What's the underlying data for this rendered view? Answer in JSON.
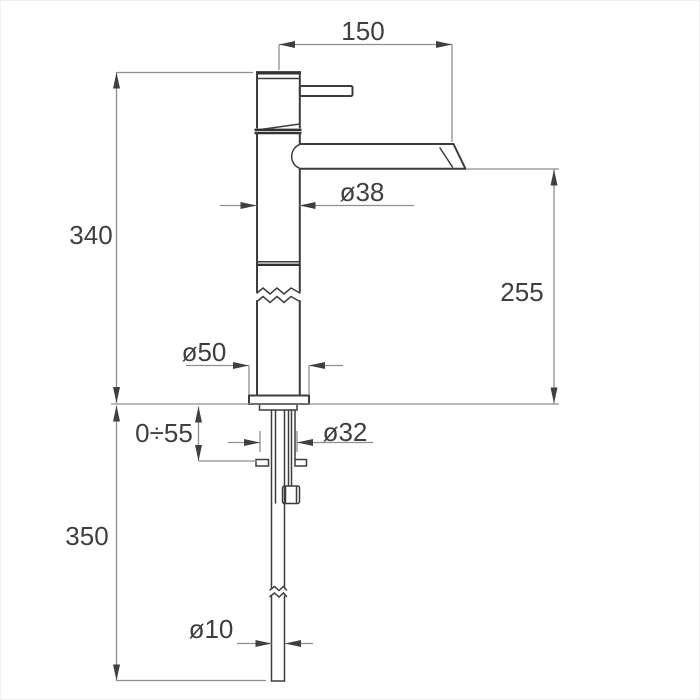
{
  "drawing": {
    "kind": "technical-dimension-drawing",
    "subject": "tall single-lever basin mixer tap, side elevation with installation dimensions",
    "units": "mm",
    "colors": {
      "outline": "#3d3d3d",
      "dimension_lines": "#8f8f8f",
      "text": "#3f3f3f",
      "background": "#ffffff"
    },
    "dimensions": {
      "spout_reach": "150",
      "height_above_deck": "340",
      "spout_outlet_height": "255",
      "body_diameter": "ø38",
      "base_diameter": "ø50",
      "deck_thickness_range": "0÷55",
      "shank_diameter": "ø32",
      "length_below_deck": "350",
      "hose_diameter": "ø10"
    }
  }
}
